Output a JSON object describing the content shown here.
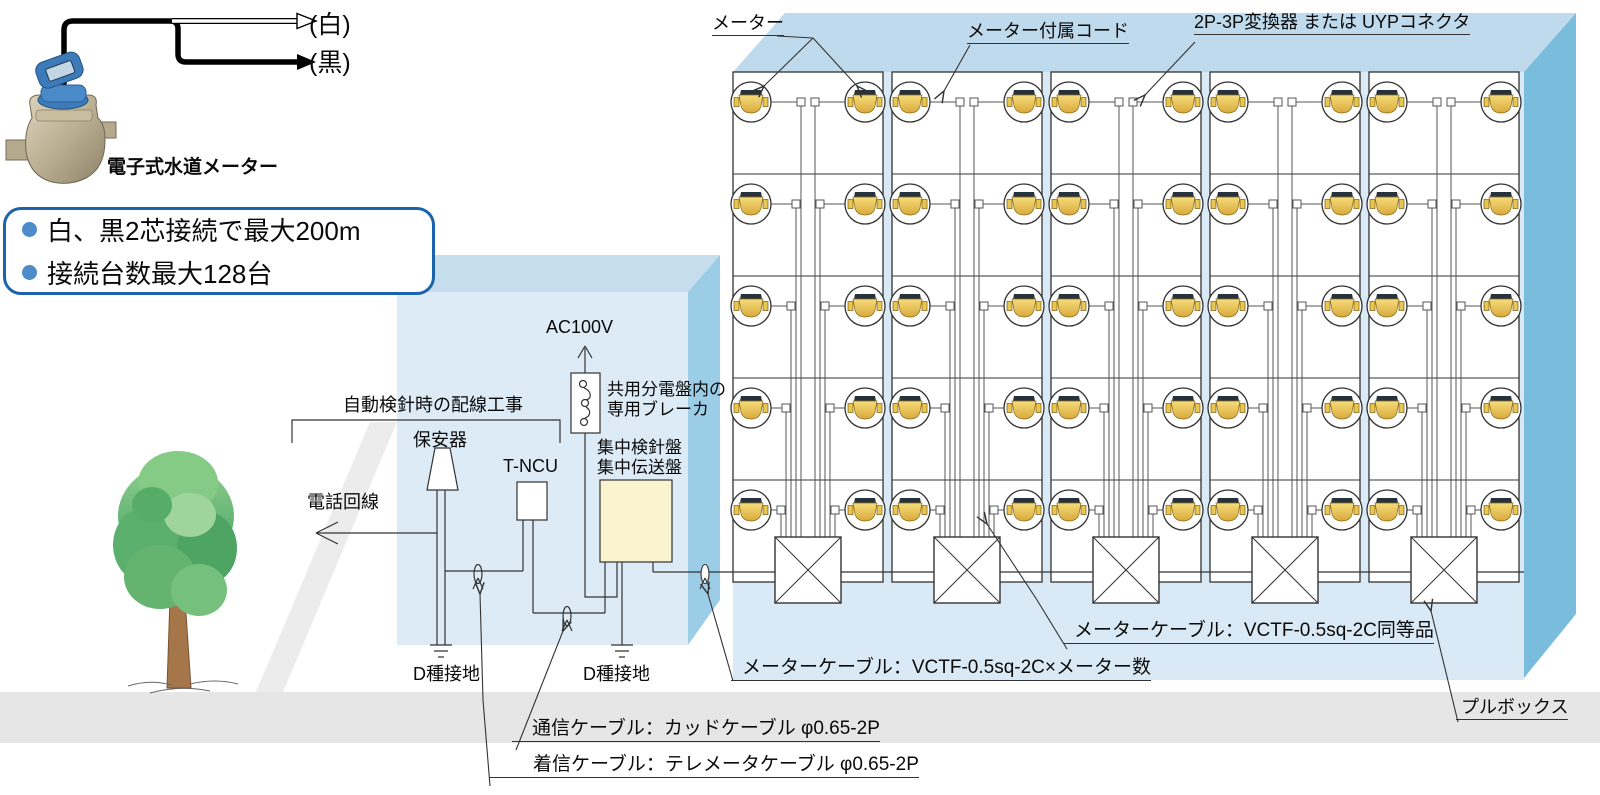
{
  "diagram_title": "電子式水道メーター集中検針システム配線図",
  "meter_unit": {
    "wire_white": "(白)",
    "wire_black": "(黒)",
    "photo_caption": "電子式水道メーター"
  },
  "callout": {
    "line1": "白、黒2芯接続で最大200m",
    "line2": "接続台数最大128台"
  },
  "machine_room": {
    "power": "AC100V",
    "breaker_line1": "共用分電盤内の",
    "breaker_line2": "専用ブレーカ",
    "panel_line1": "集中検針盤",
    "panel_line2": "集中伝送盤",
    "protector": "保安器",
    "ncu": "T-NCU",
    "phone_line": "電話回線",
    "wiring_work": "自動検針時の配線工事",
    "ground_left": "D種接地",
    "ground_right": "D種接地"
  },
  "meter_wall": {
    "meter": "メーター",
    "cord": "メーター付属コード",
    "converter": "2P-3P変換器 または UYPコネクタ",
    "pull_box": "プルボックス"
  },
  "cables": {
    "meter_cable_equivalent": "メーターケーブル：VCTF-0.5sq-2C同等品",
    "meter_cable_count": "メーターケーブル：VCTF-0.5sq-2C×メーター数",
    "communication": "通信ケーブル：カッドケーブル φ0.65-2P",
    "incoming": "着信ケーブル：テレメータケーブル φ0.65-2P"
  },
  "structure": {
    "panel_columns": 5,
    "rows_per_panel": 5,
    "meters_per_row": 2,
    "total_meters": 50,
    "pull_boxes": 5
  },
  "colors": {
    "callout_border": "#1c63ad",
    "callout_bullet": "#4d8cc9",
    "building_front": "#dcebf6",
    "building_top": "#c5dded",
    "building_side": "#9ccde7",
    "panel_front": "#d9e9f5",
    "panel_top": "#bedaec",
    "panel_side": "#7abcdc",
    "panel_face": "#ffffff",
    "distribution_box": "#faf3cf",
    "meter_body_gold": "#e9c64f",
    "meter_cap_dark": "#26333c",
    "ground_strip": "#e6e6e6",
    "path_band": "#ececec",
    "foliage_green": "#6fbe77",
    "trunk_brown": "#a5764a",
    "line": "#333333"
  }
}
